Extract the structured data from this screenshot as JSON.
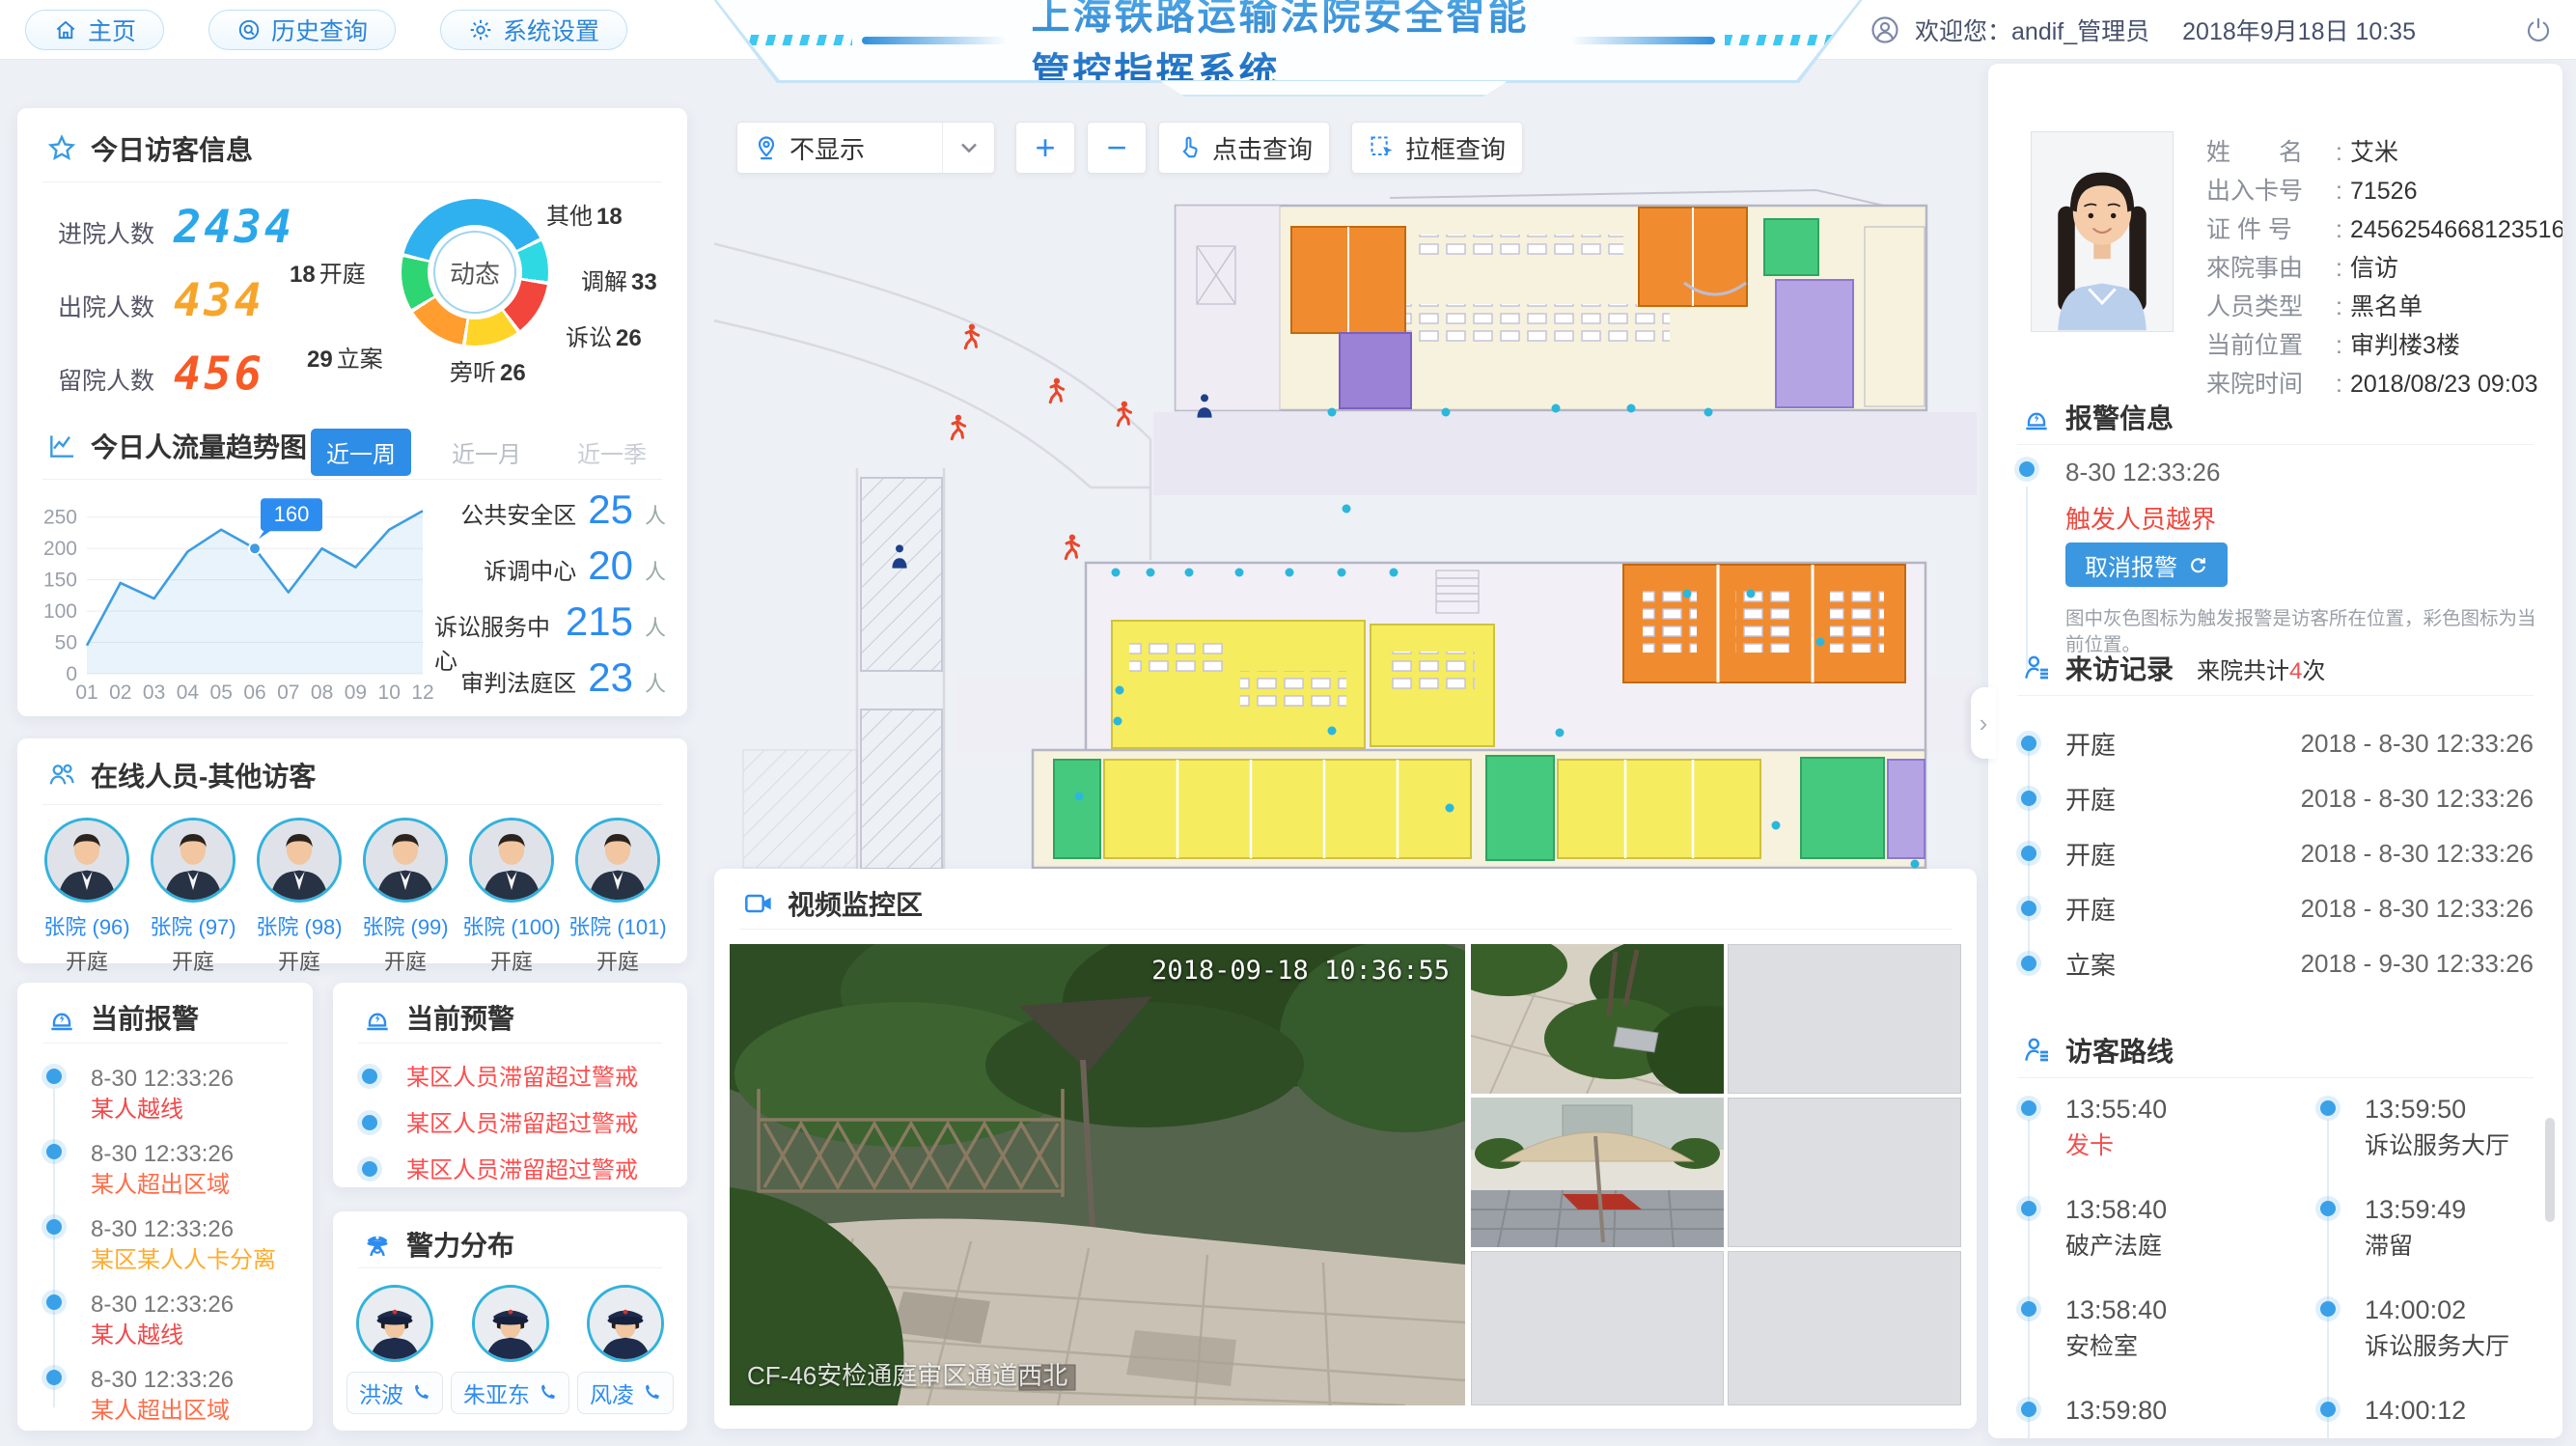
{
  "topbar": {
    "nav": [
      {
        "label": "主页"
      },
      {
        "label": "历史查询"
      },
      {
        "label": "系统设置"
      }
    ],
    "title": "上海铁路运输法院安全智能管控指挥系统",
    "welcome": "欢迎您：andif_管理员",
    "datetime": "2018年9月18日  10:35"
  },
  "visitor": {
    "title": "今日访客信息",
    "stats": [
      {
        "label": "进院人数",
        "value": "2434",
        "color": "#2aa7ea"
      },
      {
        "label": "出院人数",
        "value": "434",
        "color": "#f7a52a"
      },
      {
        "label": "留院人数",
        "value": "456",
        "color": "#f75a25"
      }
    ],
    "donut": {
      "center": "动态",
      "segments": [
        {
          "label": "其他",
          "value": "18",
          "color": "#2fb1f0"
        },
        {
          "label": "调解",
          "value": "33",
          "color": "#2ed9e4"
        },
        {
          "label": "诉讼",
          "value": "26",
          "color": "#f2463c"
        },
        {
          "label": "旁听",
          "value": "26",
          "color": "#ffd428"
        },
        {
          "label": "立案",
          "value": "29",
          "color": "#ff9d2e"
        },
        {
          "label": "开庭",
          "value": "18",
          "color": "#2ed573"
        }
      ]
    }
  },
  "trend": {
    "title": "今日人流量趋势图",
    "tabs": [
      {
        "label": "近一周"
      },
      {
        "label": "近一月"
      },
      {
        "label": "近一季"
      }
    ],
    "chart_data": {
      "type": "line",
      "x": [
        "01",
        "02",
        "03",
        "04",
        "05",
        "06",
        "07",
        "08",
        "09",
        "10",
        "12"
      ],
      "values": [
        45,
        145,
        120,
        195,
        230,
        200,
        130,
        200,
        170,
        230,
        260
      ],
      "yticks": [
        0,
        50,
        100,
        150,
        200,
        250
      ],
      "ylim": [
        0,
        265
      ],
      "marker": {
        "index": 5,
        "label": "160"
      },
      "line_color": "#3e9de2"
    },
    "area_stats": [
      {
        "label": "公共安全区",
        "value": "25",
        "unit": "人"
      },
      {
        "label": "诉调中心",
        "value": "20",
        "unit": "人"
      },
      {
        "label": "诉讼服务中心",
        "value": "215",
        "unit": "人"
      },
      {
        "label": "审判法庭区",
        "value": "23",
        "unit": "人"
      }
    ]
  },
  "online": {
    "title": "在线人员-其他访客",
    "people": [
      {
        "name": "张院 (96)",
        "status": "开庭"
      },
      {
        "name": "张院 (97)",
        "status": "开庭"
      },
      {
        "name": "张院 (98)",
        "status": "开庭"
      },
      {
        "name": "张院 (99)",
        "status": "开庭"
      },
      {
        "name": "张院 (100)",
        "status": "开庭"
      },
      {
        "name": "张院 (101)",
        "status": "开庭"
      }
    ]
  },
  "alarms": {
    "title": "当前报警",
    "items": [
      {
        "time": "8-30  12:33:26",
        "text": "某人越线",
        "color": "#f2484a"
      },
      {
        "time": "8-30  12:33:26",
        "text": "某人超出区域",
        "color": "#ff6c47"
      },
      {
        "time": "8-30  12:33:26",
        "text": "某区某人人卡分离",
        "color": "#ffab2e"
      },
      {
        "time": "8-30  12:33:26",
        "text": "某人越线",
        "color": "#f2484a"
      },
      {
        "time": "8-30  12:33:26",
        "text": "某人超出区域",
        "color": "#ff6c47"
      }
    ]
  },
  "warnings": {
    "title": "当前预警",
    "items": [
      {
        "text": "某区人员滞留超过警戒"
      },
      {
        "text": "某区人员滞留超过警戒"
      },
      {
        "text": "某区人员滞留超过警戒"
      }
    ]
  },
  "police": {
    "title": "警力分布",
    "officers": [
      {
        "name": "洪波"
      },
      {
        "name": "朱亚东"
      },
      {
        "name": "风凌"
      }
    ]
  },
  "map_toolbar": {
    "layer_select": "不显示",
    "zoom_in": "+",
    "zoom_out": "−",
    "click_query": "点击查询",
    "box_query": "拉框查询"
  },
  "video": {
    "title": "视频监控区",
    "timestamp": "2018-09-18 10:36:55",
    "camera_label": "CF-46安检通庭审区通道西北"
  },
  "person": {
    "fields": [
      {
        "label": "姓　　名",
        "value": "艾米"
      },
      {
        "label": "出入卡号",
        "value": "71526"
      },
      {
        "label": "证 件 号",
        "value": "245625466812351625"
      },
      {
        "label": "來院事由",
        "value": "信访"
      },
      {
        "label": "人员类型",
        "value": "黑名单"
      },
      {
        "label": "当前位置",
        "value": "审判楼3楼"
      },
      {
        "label": "来院时间",
        "value": "2018/08/23  09:03"
      }
    ]
  },
  "alarm_info": {
    "title": "报警信息",
    "time": "8-30  12:33:26",
    "alert": "触发人员越界",
    "cancel_label": "取消报警",
    "note": "图中灰色图标为触发报警是访客所在位置，彩色图标为当前位置。"
  },
  "visits": {
    "title": "来访记录",
    "subtitle_prefix": "来院共计",
    "count": "4",
    "subtitle_suffix": "次",
    "records": [
      {
        "type": "开庭",
        "date": "2018 - 8-30  12:33:26"
      },
      {
        "type": "开庭",
        "date": "2018 - 8-30  12:33:26"
      },
      {
        "type": "开庭",
        "date": "2018 - 8-30  12:33:26"
      },
      {
        "type": "开庭",
        "date": "2018 - 8-30  12:33:26"
      },
      {
        "type": "立案",
        "date": "2018 - 9-30  12:33:26"
      }
    ]
  },
  "route": {
    "title": "访客路线",
    "left": [
      {
        "time": "13:55:40",
        "place": "发卡",
        "red": true
      },
      {
        "time": "13:58:40",
        "place": "破产法庭"
      },
      {
        "time": "13:58:40",
        "place": "安检室"
      },
      {
        "time": "13:59:80",
        "place": ""
      }
    ],
    "right": [
      {
        "time": "13:59:50",
        "place": "诉讼服务大厅"
      },
      {
        "time": "13:59:49",
        "place": "滞留"
      },
      {
        "time": "14:00:02",
        "place": "诉讼服务大厅"
      },
      {
        "time": "14:00:12",
        "place": ""
      }
    ]
  }
}
